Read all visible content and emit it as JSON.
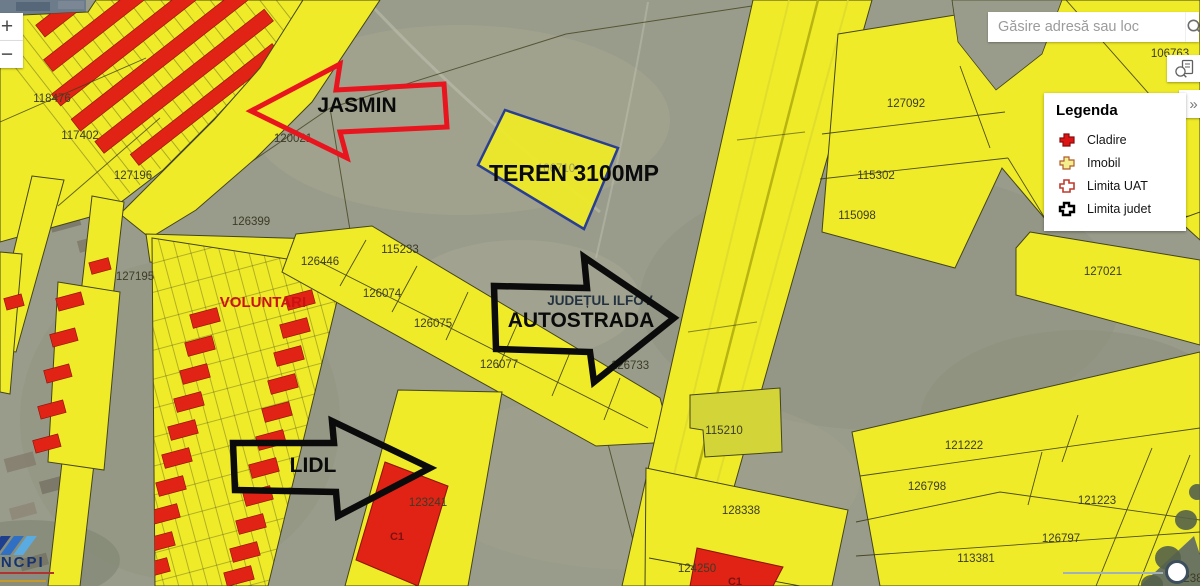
{
  "ui": {
    "search": {
      "placeholder": "Găsire adresă sau loc"
    },
    "zoom_in": "+",
    "zoom_out": "−",
    "expand": "»",
    "legend": {
      "title": "Legenda",
      "items": [
        {
          "label": "Cladire"
        },
        {
          "label": "Imobil"
        },
        {
          "label": "Limita UAT"
        },
        {
          "label": "Limita judet"
        }
      ]
    },
    "logo": {
      "text": "ANCPI"
    }
  },
  "annotations": {
    "jasmin": "JASMIN",
    "teren": "TEREN 3100MP",
    "judet": "JUDEȚUL ILFOV",
    "autostrada": "AUTOSTRADA",
    "lidl": "LIDL",
    "voluntari": "VOLUNTARI",
    "c1": "C1"
  },
  "map": {
    "parcels": [
      {
        "label": "118476"
      },
      {
        "label": "117402"
      },
      {
        "label": "127196"
      },
      {
        "label": "120021"
      },
      {
        "label": "126399"
      },
      {
        "label": "127195"
      },
      {
        "label": "126446"
      },
      {
        "label": "115233"
      },
      {
        "label": "126074"
      },
      {
        "label": "126075"
      },
      {
        "label": "126077"
      },
      {
        "label": "126733"
      },
      {
        "label": "127092"
      },
      {
        "label": "115302"
      },
      {
        "label": "115098"
      },
      {
        "label": "127021"
      },
      {
        "label": "106763"
      },
      {
        "label": "115210"
      },
      {
        "label": "128338"
      },
      {
        "label": "124250"
      },
      {
        "label": "123241"
      },
      {
        "label": "121222"
      },
      {
        "label": "126798"
      },
      {
        "label": "121223"
      },
      {
        "label": "126797"
      },
      {
        "label": "113381"
      }
    ],
    "faint_parcel": "106710",
    "partial_parcel": "238"
  },
  "colors": {
    "parcel_yellow": "#efeb28",
    "building_red": "#e02315",
    "teren_outline": "#2a3f8f",
    "arrow_red": "#e8141e",
    "arrow_black": "#0b0b0b",
    "legend_cladire": "#dd1414",
    "legend_imobil": "#f3ee8e",
    "legend_uat_stroke": "#c0392b",
    "legend_judet_stroke": "#000000"
  }
}
